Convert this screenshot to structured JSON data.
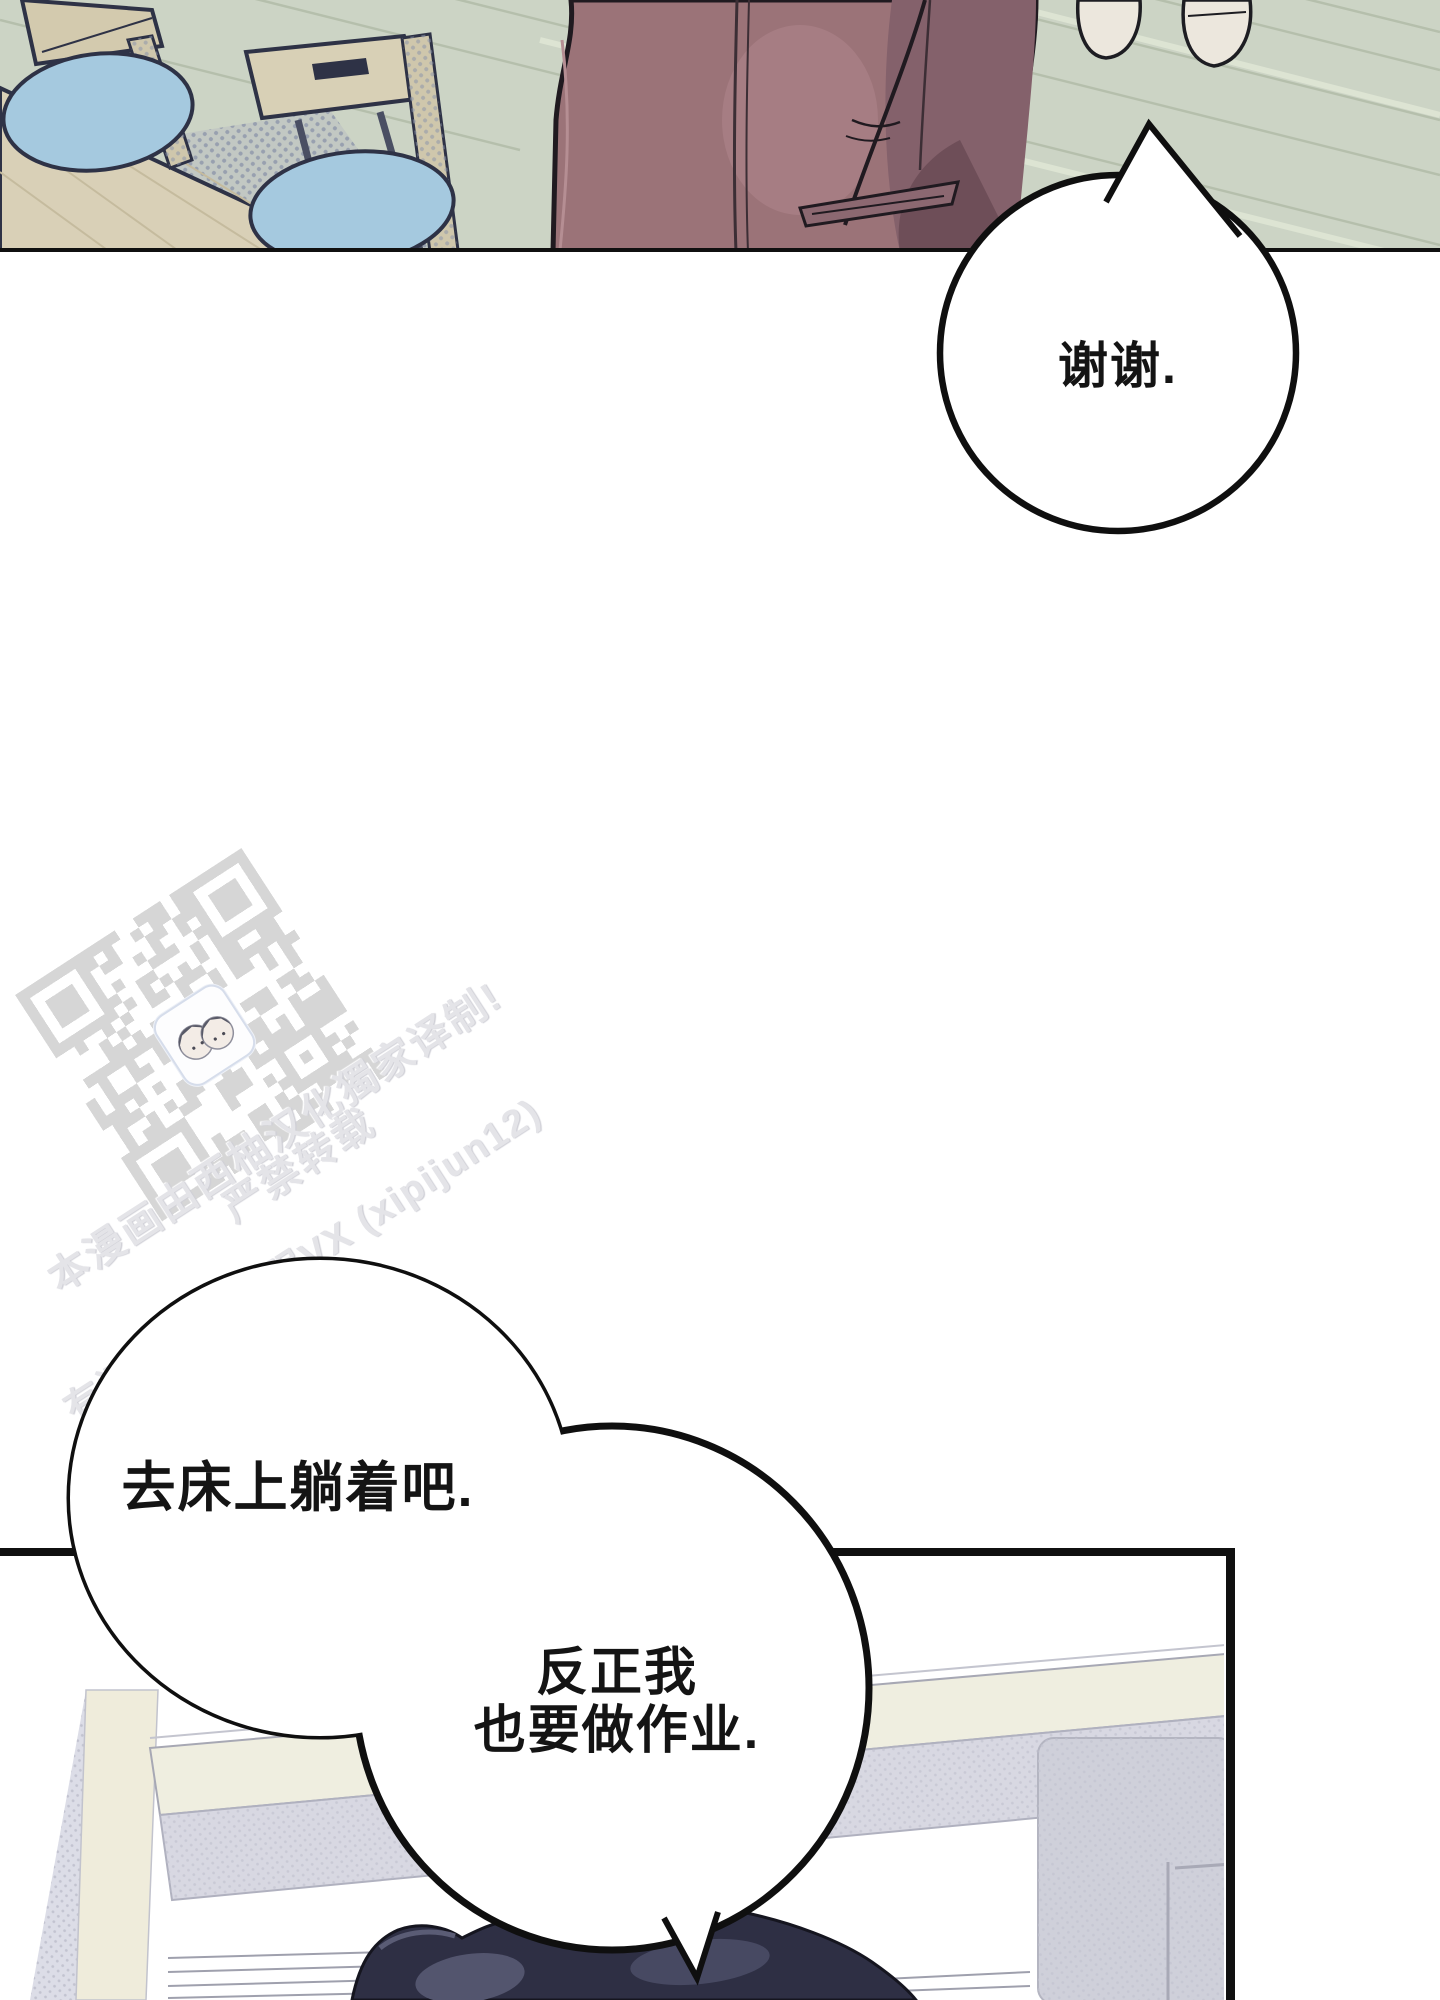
{
  "page": {
    "width": 1440,
    "height": 2000,
    "background": "#ffffff"
  },
  "panels": {
    "top_scene": "dining-room-floor-table-chairs-person-in-jacket",
    "bottom_scene": "desk-room-person-lying"
  },
  "bubbles": {
    "thanks": {
      "text": "谢谢."
    },
    "bed": {
      "text": "去床上躺着吧."
    },
    "homework": {
      "lines": [
        "反正我",
        "也要做作业."
      ]
    }
  },
  "watermark": {
    "line1": "本漫画由西柚汉化獨家译制!",
    "line2": "严禁转载",
    "line3": "有问题添加客服VX (xipijun12)"
  },
  "colors": {
    "floor": "#ccd4c5",
    "plank_line": "#b5bfac",
    "table_wood": "#d9d0b7",
    "chair_wood": "#d3caae",
    "cushion_blue": "#a5c9df",
    "jacket_main": "#9b7378",
    "jacket_shadow": "#84616b",
    "panel_border": "#101010",
    "bubble_stroke": "#0f0f0f",
    "qr_gray": "#d6d6d6",
    "watermark_gray": "#e4e4e8",
    "cream_band": "#efeee0",
    "hatch_gray": "#d8d8e2",
    "dark_blob": "#2e2f44"
  }
}
